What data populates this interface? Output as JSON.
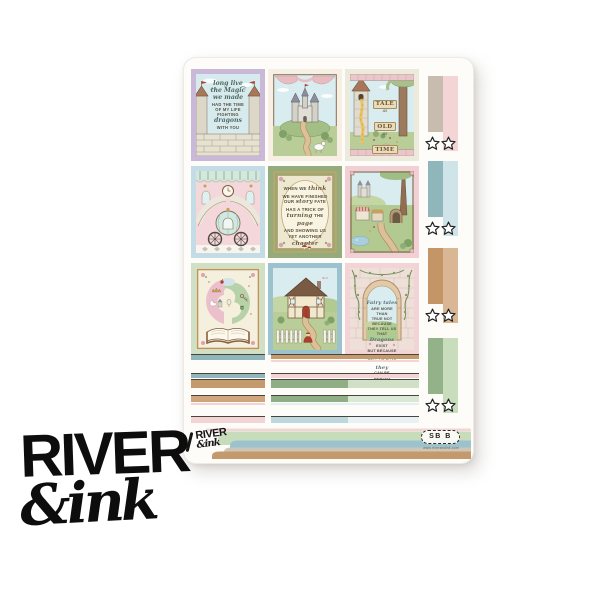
{
  "brand": {
    "watermark_line1": "RIVER",
    "watermark_line2": "&ink",
    "sheet_logo_line1": "RIVER",
    "sheet_logo_line2": "&ink",
    "stamp_code": "SB B",
    "stamp_url": "www.riverandink.com"
  },
  "kit": {
    "boxes": [
      {
        "name": "long-live-dragons-quote-box",
        "mat_color": "#c9b8d8",
        "quote": "long live the magic we made - had the time of my life fighting dragons with you",
        "lines": [
          {
            "t": "long live",
            "s": "script"
          },
          {
            "t": "the Magic",
            "s": "script"
          },
          {
            "t": "we made",
            "s": "script"
          },
          {
            "t": "HAD THE TIME",
            "s": "caps"
          },
          {
            "t": "OF MY LIFE",
            "s": "caps"
          },
          {
            "t": "FIGHTING",
            "s": "caps"
          },
          {
            "t": "dragons",
            "s": "script"
          },
          {
            "t": "WITH YOU",
            "s": "caps"
          }
        ],
        "scene": "castle wall and twin turrets with flags"
      },
      {
        "name": "castle-on-hill-box",
        "mat_color": "#f7efe3",
        "scene": "grey fairy-tale castle on a green hill, winding path, unicorn, pink drapes"
      },
      {
        "name": "tale-as-old-as-time-box",
        "mat_color": "#eceadb",
        "quote": "tale as old as time",
        "lines": [
          {
            "t": "TALE"
          },
          {
            "t": "as"
          },
          {
            "t": "OLD"
          },
          {
            "t": "as"
          },
          {
            "t": "TIME"
          }
        ],
        "scene": "rapunzel tower with golden hair beside a tall tree"
      },
      {
        "name": "ballroom-pumpkin-carriage-box",
        "mat_color": "#c3dce6",
        "scene": "palace ballroom, twin staircases, midnight clock, pumpkin carriage on checkered floor"
      },
      {
        "name": "another-chapter-quote-box",
        "mat_color": "#96ab7c",
        "quote": "when we think we have finished our story, fate has a trick of turning the page and showing us yet another chapter",
        "lines": [
          [
            {
              "t": "WHEN WE ",
              "s": "caps"
            },
            {
              "t": "think",
              "s": "script"
            }
          ],
          [
            {
              "t": "WE HAVE FINISHED",
              "s": "caps"
            }
          ],
          [
            {
              "t": "OUR ",
              "s": "caps"
            },
            {
              "t": "story",
              "s": "script"
            },
            {
              "t": " FATE",
              "s": "caps"
            }
          ],
          [
            {
              "t": "HAS A TRICK OF",
              "s": "caps"
            }
          ],
          [
            {
              "t": "turning",
              "s": "script"
            },
            {
              "t": " THE ",
              "s": "caps"
            },
            {
              "t": "page",
              "s": "script"
            }
          ],
          [
            {
              "t": "AND SHOWING US",
              "s": "caps"
            }
          ],
          [
            {
              "t": "YET ANOTHER",
              "s": "caps"
            }
          ],
          [
            {
              "t": "chapter",
              "s": "script"
            }
          ]
        ],
        "scene": "cream oval plaque in ornate gold frame with mushrooms and florals"
      },
      {
        "name": "storybook-village-box",
        "mat_color": "#f2cfd4",
        "scene": "village market stalls, winding road, pond, big tree and distant castle"
      },
      {
        "name": "magic-storybook-box",
        "mat_color": "#cfe0c6",
        "scene": "open storybook with pink and green magic swirls of fairy-tale charms"
      },
      {
        "name": "fairytale-cottage-box",
        "mat_color": "#9cc3cd",
        "scene": "tudor cottage behind white picket fence with red riding hood on the path"
      },
      {
        "name": "dragons-can-be-beaten-quote-box",
        "mat_color": "#f2d4d6",
        "quote": "fairy tales are more than true: not because they tell us that dragons exist, but because they tell us that dragons can be beaten",
        "lines": [
          [
            {
              "t": "Fairy tales",
              "s": "script"
            }
          ],
          [
            {
              "t": "ARE MORE THAN",
              "s": "caps"
            }
          ],
          [
            {
              "t": "TRUE NOT BECAUSE",
              "s": "caps"
            }
          ],
          [
            {
              "t": "THEY TELL US THAT",
              "s": "caps"
            }
          ],
          [
            {
              "t": "Dragons",
              "s": "script"
            },
            {
              "t": " EXIST",
              "s": "caps"
            }
          ],
          [
            {
              "t": "BUT BECAUSE THEY",
              "s": "caps"
            }
          ],
          [
            {
              "t": "TELL US THAT ",
              "s": "caps"
            },
            {
              "t": "they",
              "s": "script"
            }
          ],
          [
            {
              "t": "CAN BE BEATEN",
              "s": "caps"
            }
          ]
        ],
        "scene": "stone wall with ivy and arched window onto a meadow"
      }
    ],
    "side_tabs": [
      {
        "name": "tab-blush",
        "left_color": "#c8bcae",
        "right_color": "#f3d5d5",
        "star_stickers": 2
      },
      {
        "name": "tab-teal",
        "left_color": "#8fb6ba",
        "right_color": "#cfe4e9",
        "star_stickers": 2
      },
      {
        "name": "tab-tan",
        "left_color": "#c39567",
        "right_color": "#d9b795",
        "star_stickers": 2
      },
      {
        "name": "tab-green",
        "left_color": "#93b289",
        "right_color": "#c8ddbc",
        "star_stickers": 2
      }
    ],
    "star_sticker": {
      "icon": "star-outline-icon",
      "total": 8,
      "fill": "#ffffff",
      "outline": "#222222"
    },
    "strips": {
      "colors": {
        "teal": "#8fb6ba",
        "tan": "#c49a6c",
        "light_tan": "#cfa57c",
        "pink": "#f2d4d4",
        "green": "#8fae85",
        "light_green": "#cfe0c6",
        "blue": "#bcd8de",
        "light_blue": "#e8f2f4"
      },
      "rows": [
        {
          "left": [
            "teal"
          ],
          "right": [
            "tan",
            "pink"
          ]
        },
        {
          "left": [
            "teal",
            "tan"
          ],
          "right": [
            "pink",
            "green+light_green"
          ]
        },
        {
          "left": [
            "light_tan",
            "pink"
          ],
          "right": [
            "green+light_green",
            "light_blue"
          ]
        },
        {
          "left": [
            "pink"
          ],
          "right": [
            "blue+light_blue"
          ]
        }
      ]
    },
    "banner_wave_colors": [
      "#f2d4d4",
      "#c6dcba",
      "#9cc3cd",
      "#cdc5b8",
      "#c49a6c"
    ]
  }
}
